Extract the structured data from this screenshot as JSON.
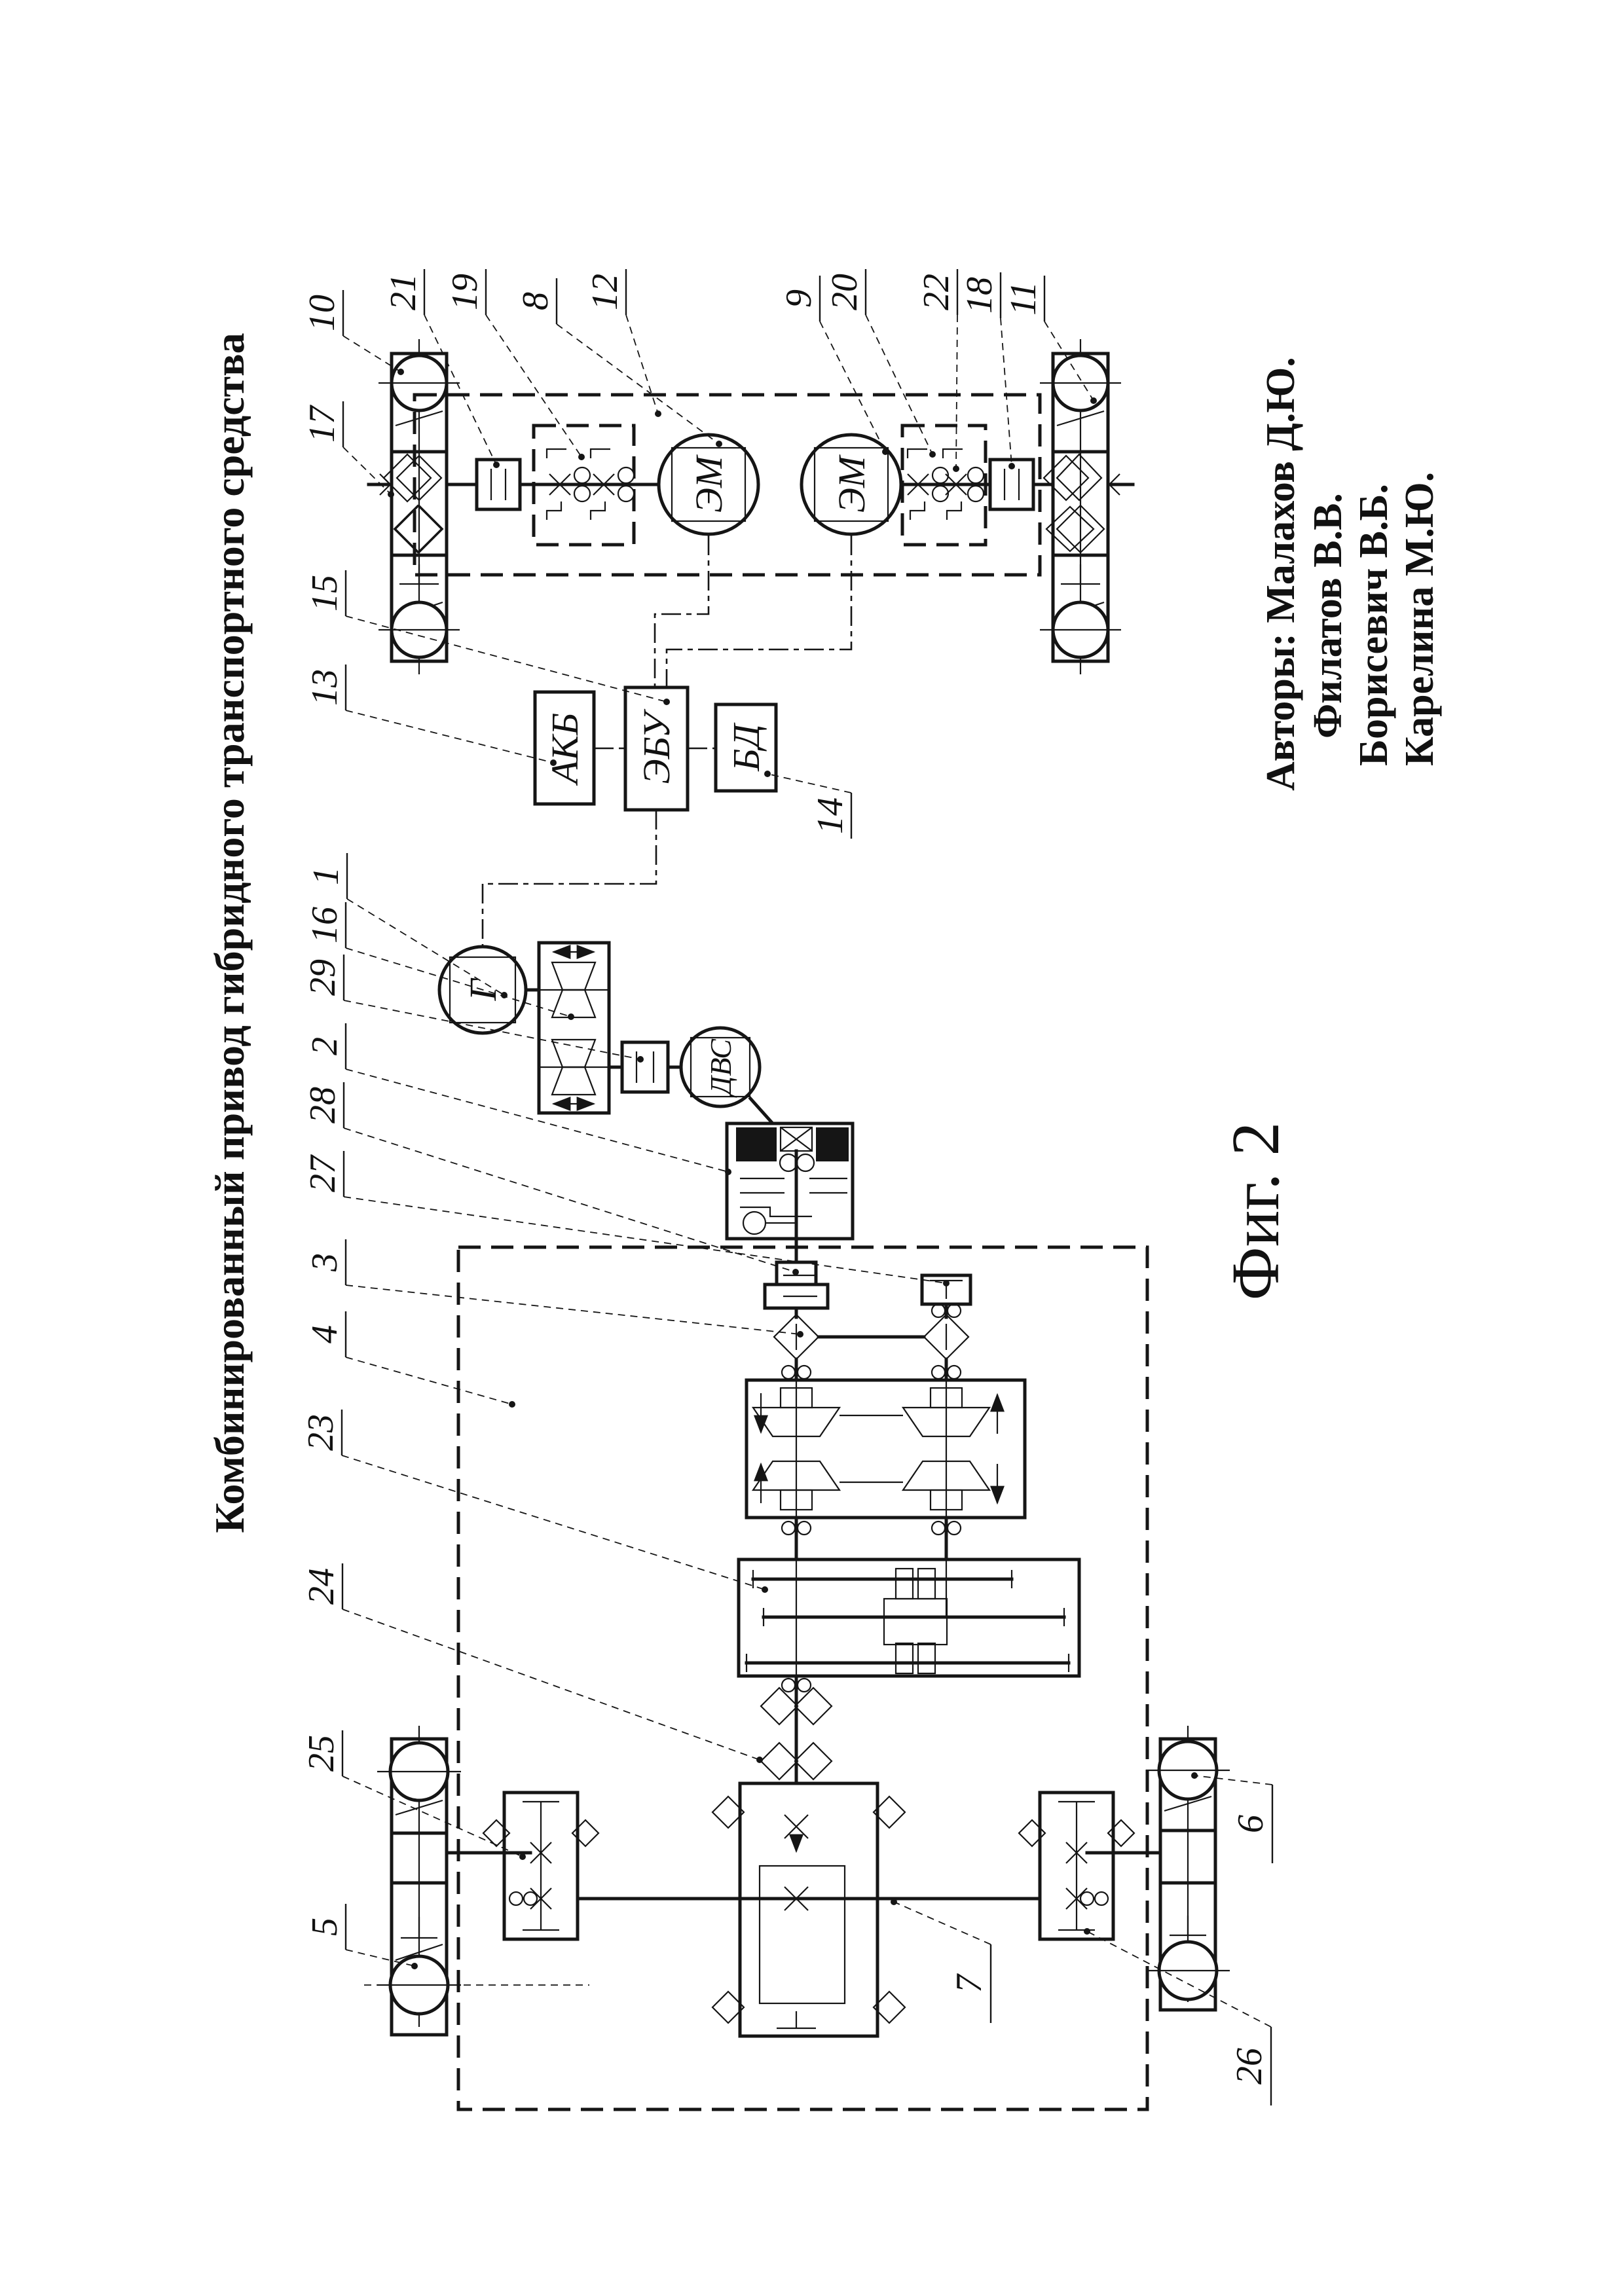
{
  "page": {
    "background": "#ffffff",
    "ink": "#151515"
  },
  "title": "Комбинированный привод гибридного транспортного средства",
  "figure_label": "Фиг. 2",
  "authors": [
    "Авторы: Малахов Д.Ю.",
    "Филатов В.В.",
    "Борисевич В.Б.",
    "Карелина М.Ю."
  ],
  "component_labels": {
    "motor_left": "ЭМ",
    "motor_right": "ЭМ",
    "battery": "АКБ",
    "control_unit": "ЭБУ",
    "database": "БД",
    "generator": "Г",
    "engine": "ДВС"
  },
  "callouts": [
    {
      "label": "10"
    },
    {
      "label": "17"
    },
    {
      "label": "15"
    },
    {
      "label": "13"
    },
    {
      "label": "1"
    },
    {
      "label": "16"
    },
    {
      "label": "29"
    },
    {
      "label": "2"
    },
    {
      "label": "28"
    },
    {
      "label": "27"
    },
    {
      "label": "3"
    },
    {
      "label": "4"
    },
    {
      "label": "23"
    },
    {
      "label": "24"
    },
    {
      "label": "25"
    },
    {
      "label": "5"
    },
    {
      "label": "21"
    },
    {
      "label": "19"
    },
    {
      "label": "8"
    },
    {
      "label": "12"
    },
    {
      "label": "9"
    },
    {
      "label": "20"
    },
    {
      "label": "22"
    },
    {
      "label": "18"
    },
    {
      "label": "11"
    },
    {
      "label": "14"
    },
    {
      "label": "7"
    },
    {
      "label": "6"
    },
    {
      "label": "26"
    }
  ]
}
